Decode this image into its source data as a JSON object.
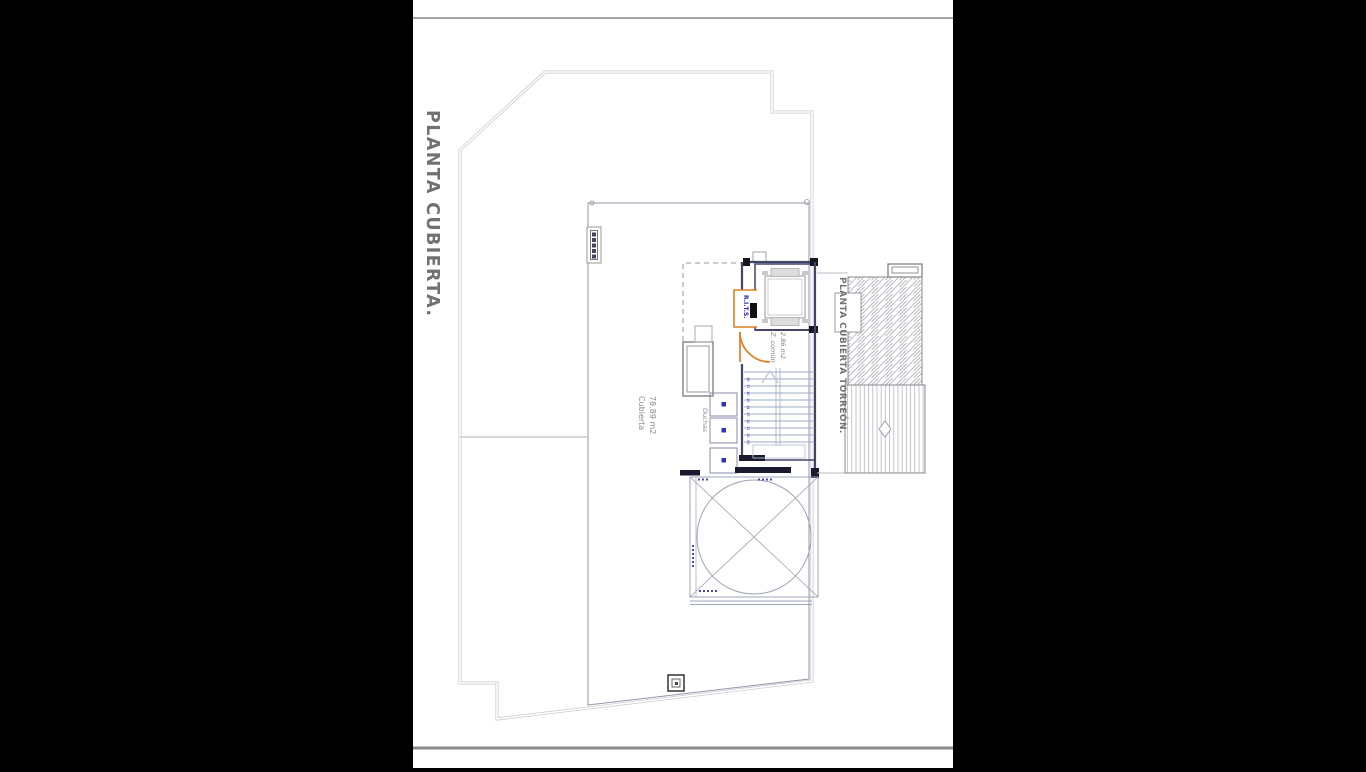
{
  "page": {
    "background": "#000000",
    "sheet_background": "#ffffff"
  },
  "titles": {
    "main": "PLANTA CUBIERTA.",
    "torreon": "PLANTA CUBIERTA TORREÓN."
  },
  "labels": {
    "roof_area_name": "Cubierta",
    "roof_area_value": "78.89 m2",
    "showers": "Duchas",
    "common_zone_name": "Z. común",
    "common_zone_value": "2.86 m2",
    "rits": "R.I.T.S."
  },
  "stairs": {
    "step_numbers": [
      "18",
      "17",
      "16",
      "15",
      "14",
      "13",
      "12",
      "11",
      "10",
      "09"
    ]
  },
  "colors": {
    "accent_orange": "#e07818",
    "accent_blue": "#3232b4",
    "wall_dark": "#3f3f60",
    "line_grey": "#9aa4bc",
    "outline_light": "#c6c6ce",
    "text_grey": "#737373"
  }
}
